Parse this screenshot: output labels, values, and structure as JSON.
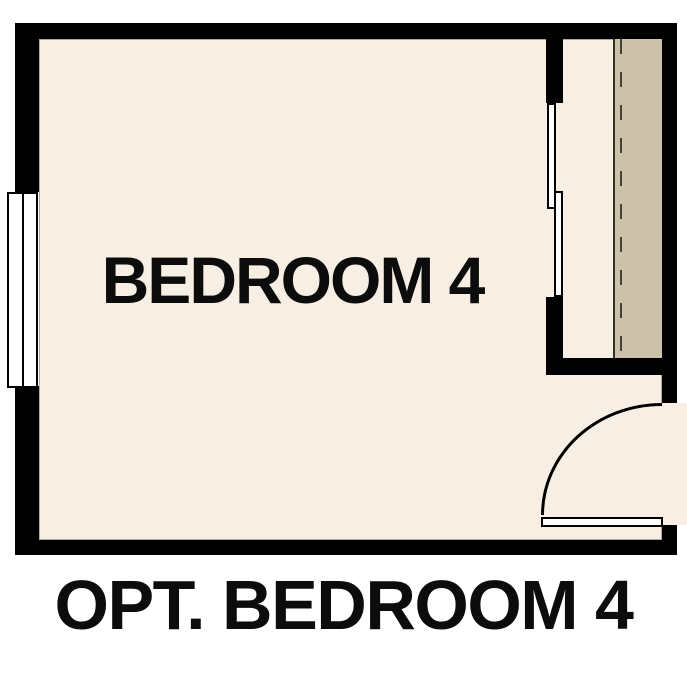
{
  "title": "Optional Bedroom 4 floor plan",
  "room": {
    "label": "BEDROOM 4"
  },
  "caption": "OPT. BEDROOM 4",
  "features": {
    "window": "double-pane window on left wall",
    "closet": "closet on right side",
    "closet_shelf": "shelf band",
    "closet_rod": "hanging rod (dashed line)",
    "closet_doors": "bypass sliding doors",
    "entry_door": "hinged door with quarter-circle swing arc"
  },
  "colors": {
    "background": "#ffffff",
    "wall": "#000000",
    "floor": "#f7efe3",
    "closet_shelf": "#ccc2a9",
    "rod_dash": "#46423a",
    "text": "#0c0c0c"
  }
}
